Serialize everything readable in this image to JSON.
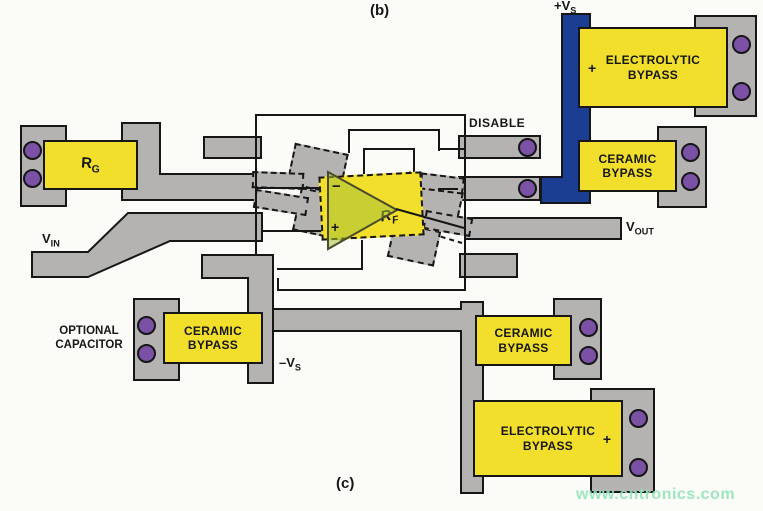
{
  "figure": {
    "panel_top": "(b)",
    "panel_bottom": "(c)",
    "watermark": "www.cntronics.com"
  },
  "colors": {
    "trace_gray": "#b5b2b2",
    "pad_purple": "#7b51a5",
    "power_blue": "#1c3e92",
    "component_yellow": "#f2df2b",
    "opamp_fill": "rgba(167,193,56,0.55)",
    "outline": "#161616",
    "watermark_green": "#93e4bb",
    "background": "#fbfbf8"
  },
  "signals": {
    "disable": "DISABLE",
    "vin": {
      "main": "V",
      "sub": "IN"
    },
    "vout": {
      "main": "V",
      "sub": "OUT"
    },
    "pos_supply": {
      "pre": "+",
      "main": "V",
      "sub": "S"
    },
    "neg_supply": {
      "pre": "–",
      "main": "V",
      "sub": "S"
    }
  },
  "components": {
    "rg": {
      "main": "R",
      "sub": "G"
    },
    "rf": {
      "main": "R",
      "sub": "F"
    },
    "opamp": {
      "minus": "−",
      "plus": "+"
    },
    "electrolytic_top": {
      "line1": "ELECTROLYTIC",
      "line2": "BYPASS",
      "polarity": "+"
    },
    "ceramic_top": {
      "line1": "CERAMIC",
      "line2": "BYPASS"
    },
    "ceramic_bottom_left": {
      "line1": "CERAMIC",
      "line2": "BYPASS"
    },
    "ceramic_bottom_right": {
      "line1": "CERAMIC",
      "line2": "BYPASS"
    },
    "electrolytic_bottom": {
      "line1": "ELECTROLYTIC",
      "line2": "BYPASS",
      "polarity": "+"
    },
    "optional_capacitor": {
      "line1": "OPTIONAL",
      "line2": "CAPACITOR"
    }
  }
}
